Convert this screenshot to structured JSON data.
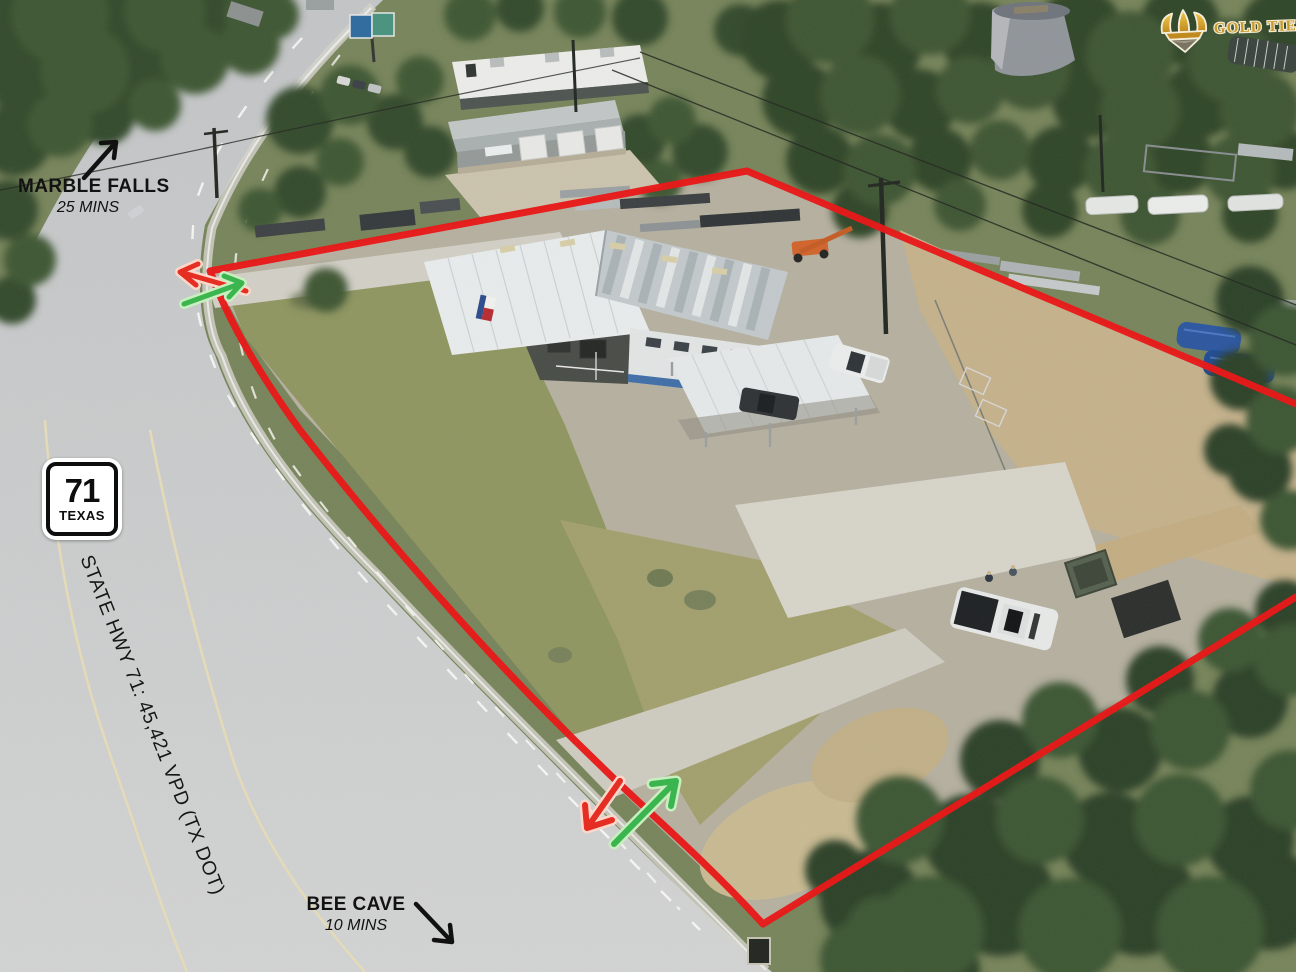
{
  "annotations": {
    "marble_falls": {
      "name": "MARBLE FALLS",
      "time": "25 MINS"
    },
    "bee_cave": {
      "name": "BEE CAVE",
      "time": "10 MINS"
    },
    "highway_shield": {
      "route": "71",
      "state": "TEXAS"
    },
    "traffic_stat": "STATE HWY 71: 45,421 VPD (TX DOT)",
    "brand_badge": {
      "label": "GOLD TIER"
    }
  },
  "colors": {
    "boundary": "#ea1212",
    "exit_arrow": "#e8271c",
    "enter_arrow": "#35b54a",
    "badge_gold": "#c9992b"
  }
}
